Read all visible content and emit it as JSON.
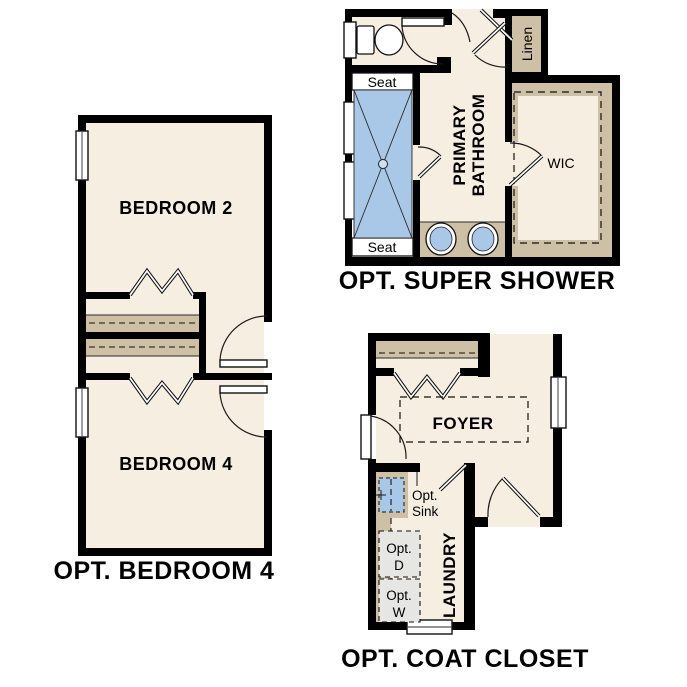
{
  "colors": {
    "background": "#ffffff",
    "floor_cream": "#f6eee1",
    "shelf_tan": "#cdc0a5",
    "water_blue": "#a9c8e8",
    "appliance_gray": "#e6e6e2",
    "wall_black": "#000000"
  },
  "plans": {
    "bedroom4": {
      "title": "OPT. BEDROOM 4",
      "bedroom2_label": "BEDROOM 2",
      "bedroom4_label": "BEDROOM 4"
    },
    "super_shower": {
      "title": "OPT. SUPER SHOWER",
      "seat_top": "Seat",
      "seat_bottom": "Seat",
      "primary_line1": "PRIMARY",
      "primary_line2": "BATHROOM",
      "linen": "Linen",
      "wic": "WIC"
    },
    "coat_closet": {
      "title": "OPT. COAT CLOSET",
      "foyer": "FOYER",
      "laundry": "LAUNDRY",
      "opt_sink_line1": "Opt.",
      "opt_sink_line2": "Sink",
      "opt_d_line1": "Opt.",
      "opt_d_line2": "D",
      "opt_w_line1": "Opt.",
      "opt_w_line2": "W"
    }
  }
}
